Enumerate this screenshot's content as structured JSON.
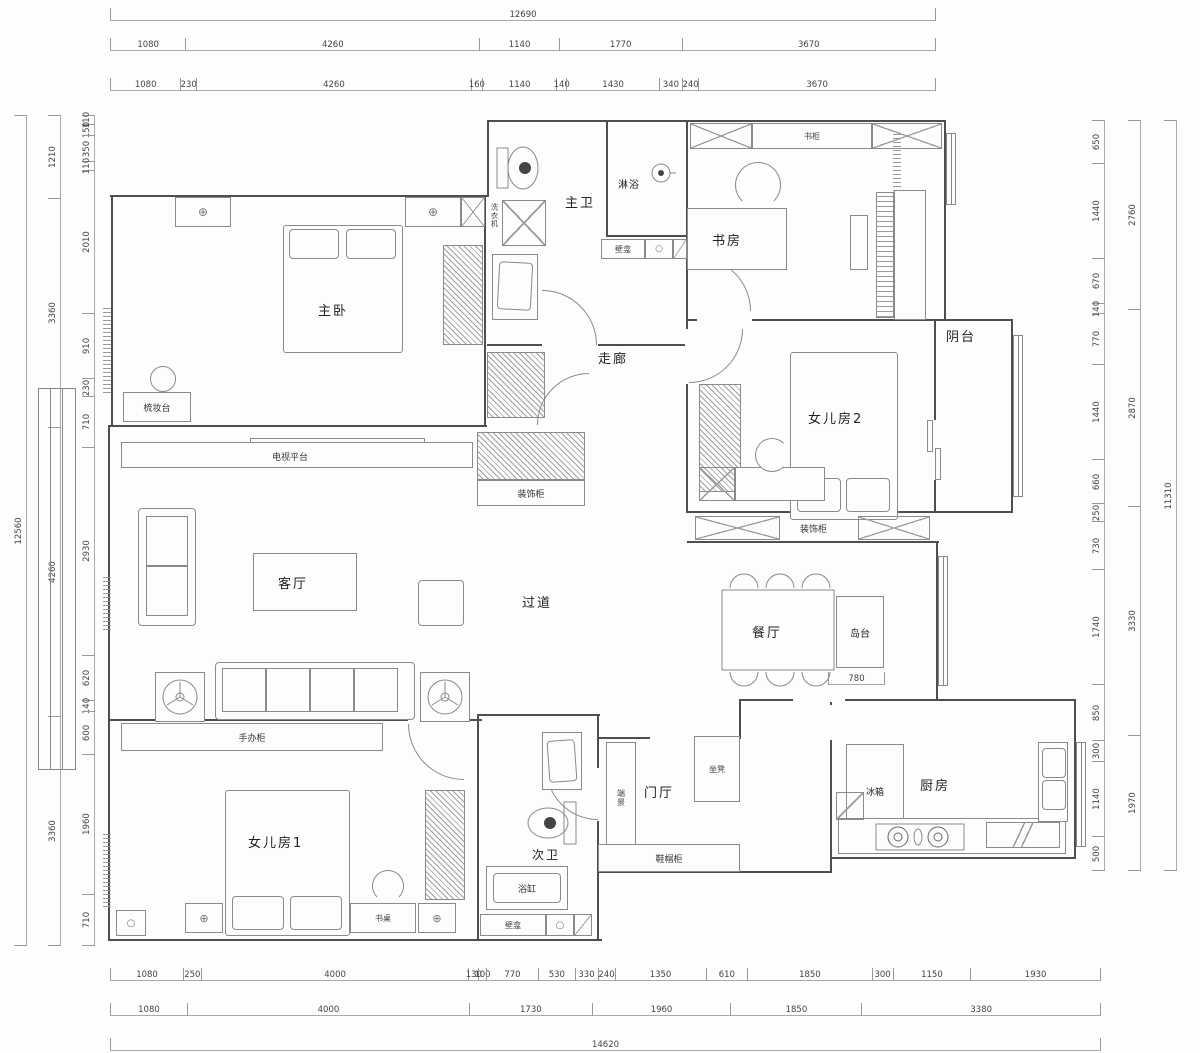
{
  "plan": {
    "rooms": {
      "master_bedroom": "主卧",
      "master_bath": "主卫",
      "shower": "淋浴",
      "study": "书房",
      "hallway": "走廊",
      "daughter_room_2": "女儿房2",
      "balcony": "阴台",
      "living_room": "客厅",
      "passage": "过道",
      "dining_room": "餐厅",
      "kitchen": "厨房",
      "daughter_room_1": "女儿房1",
      "second_bath": "次卫",
      "foyer": "门厅"
    },
    "fixtures": {
      "island": "岛台",
      "washing_machine": "洗衣机",
      "niche_master": "壁龛",
      "bookcase": "书柜",
      "dresser": "梳妆台",
      "tv_platform": "电视平台",
      "deco_cabinet_hall": "装饰柜",
      "deco_cabinet_d2": "装饰柜",
      "figure_cabinet": "手办柜",
      "desk": "书桌",
      "bathtub": "浴缸",
      "niche_bath2": "壁龛",
      "shoe_cabinet": "鞋帽柜",
      "end_feature": "端景",
      "bench": "坐凳",
      "fridge": "冰箱"
    }
  },
  "dimensions": {
    "top": {
      "total": [
        "12690"
      ],
      "mid": [
        "1080",
        "4260",
        "1140",
        "1770",
        "3670"
      ],
      "detail": [
        "1080",
        "230",
        "4260",
        "160",
        "1140",
        "140",
        "1430",
        "340",
        "240",
        "3670"
      ]
    },
    "bottom": {
      "detail": [
        "1080",
        "250",
        "4000",
        "130",
        "100",
        "770",
        "530",
        "330",
        "240",
        "1350",
        "610",
        "1850",
        "300",
        "1150",
        "1930"
      ],
      "mid": [
        "1080",
        "4000",
        "1730",
        "1960",
        "1850",
        "3380"
      ],
      "total": [
        "14620"
      ]
    },
    "left": {
      "total": [
        "12560"
      ],
      "mid": [
        "1210",
        "3360",
        "4260",
        "3360"
      ],
      "detail": [
        "110",
        "150",
        "350",
        "110",
        "2010",
        "910",
        "230",
        "710",
        "2930",
        "620",
        "140",
        "600",
        "1960",
        "710"
      ]
    },
    "right": {
      "detail": [
        "650",
        "1440",
        "670",
        "140",
        "770",
        "1440",
        "660",
        "250",
        "730",
        "1740",
        "850",
        "300",
        "1140",
        "500"
      ],
      "mid": [
        "2760",
        "2870",
        "3330",
        "1970"
      ],
      "total": [
        "11310"
      ]
    },
    "island_clearance": [
      "780"
    ]
  }
}
